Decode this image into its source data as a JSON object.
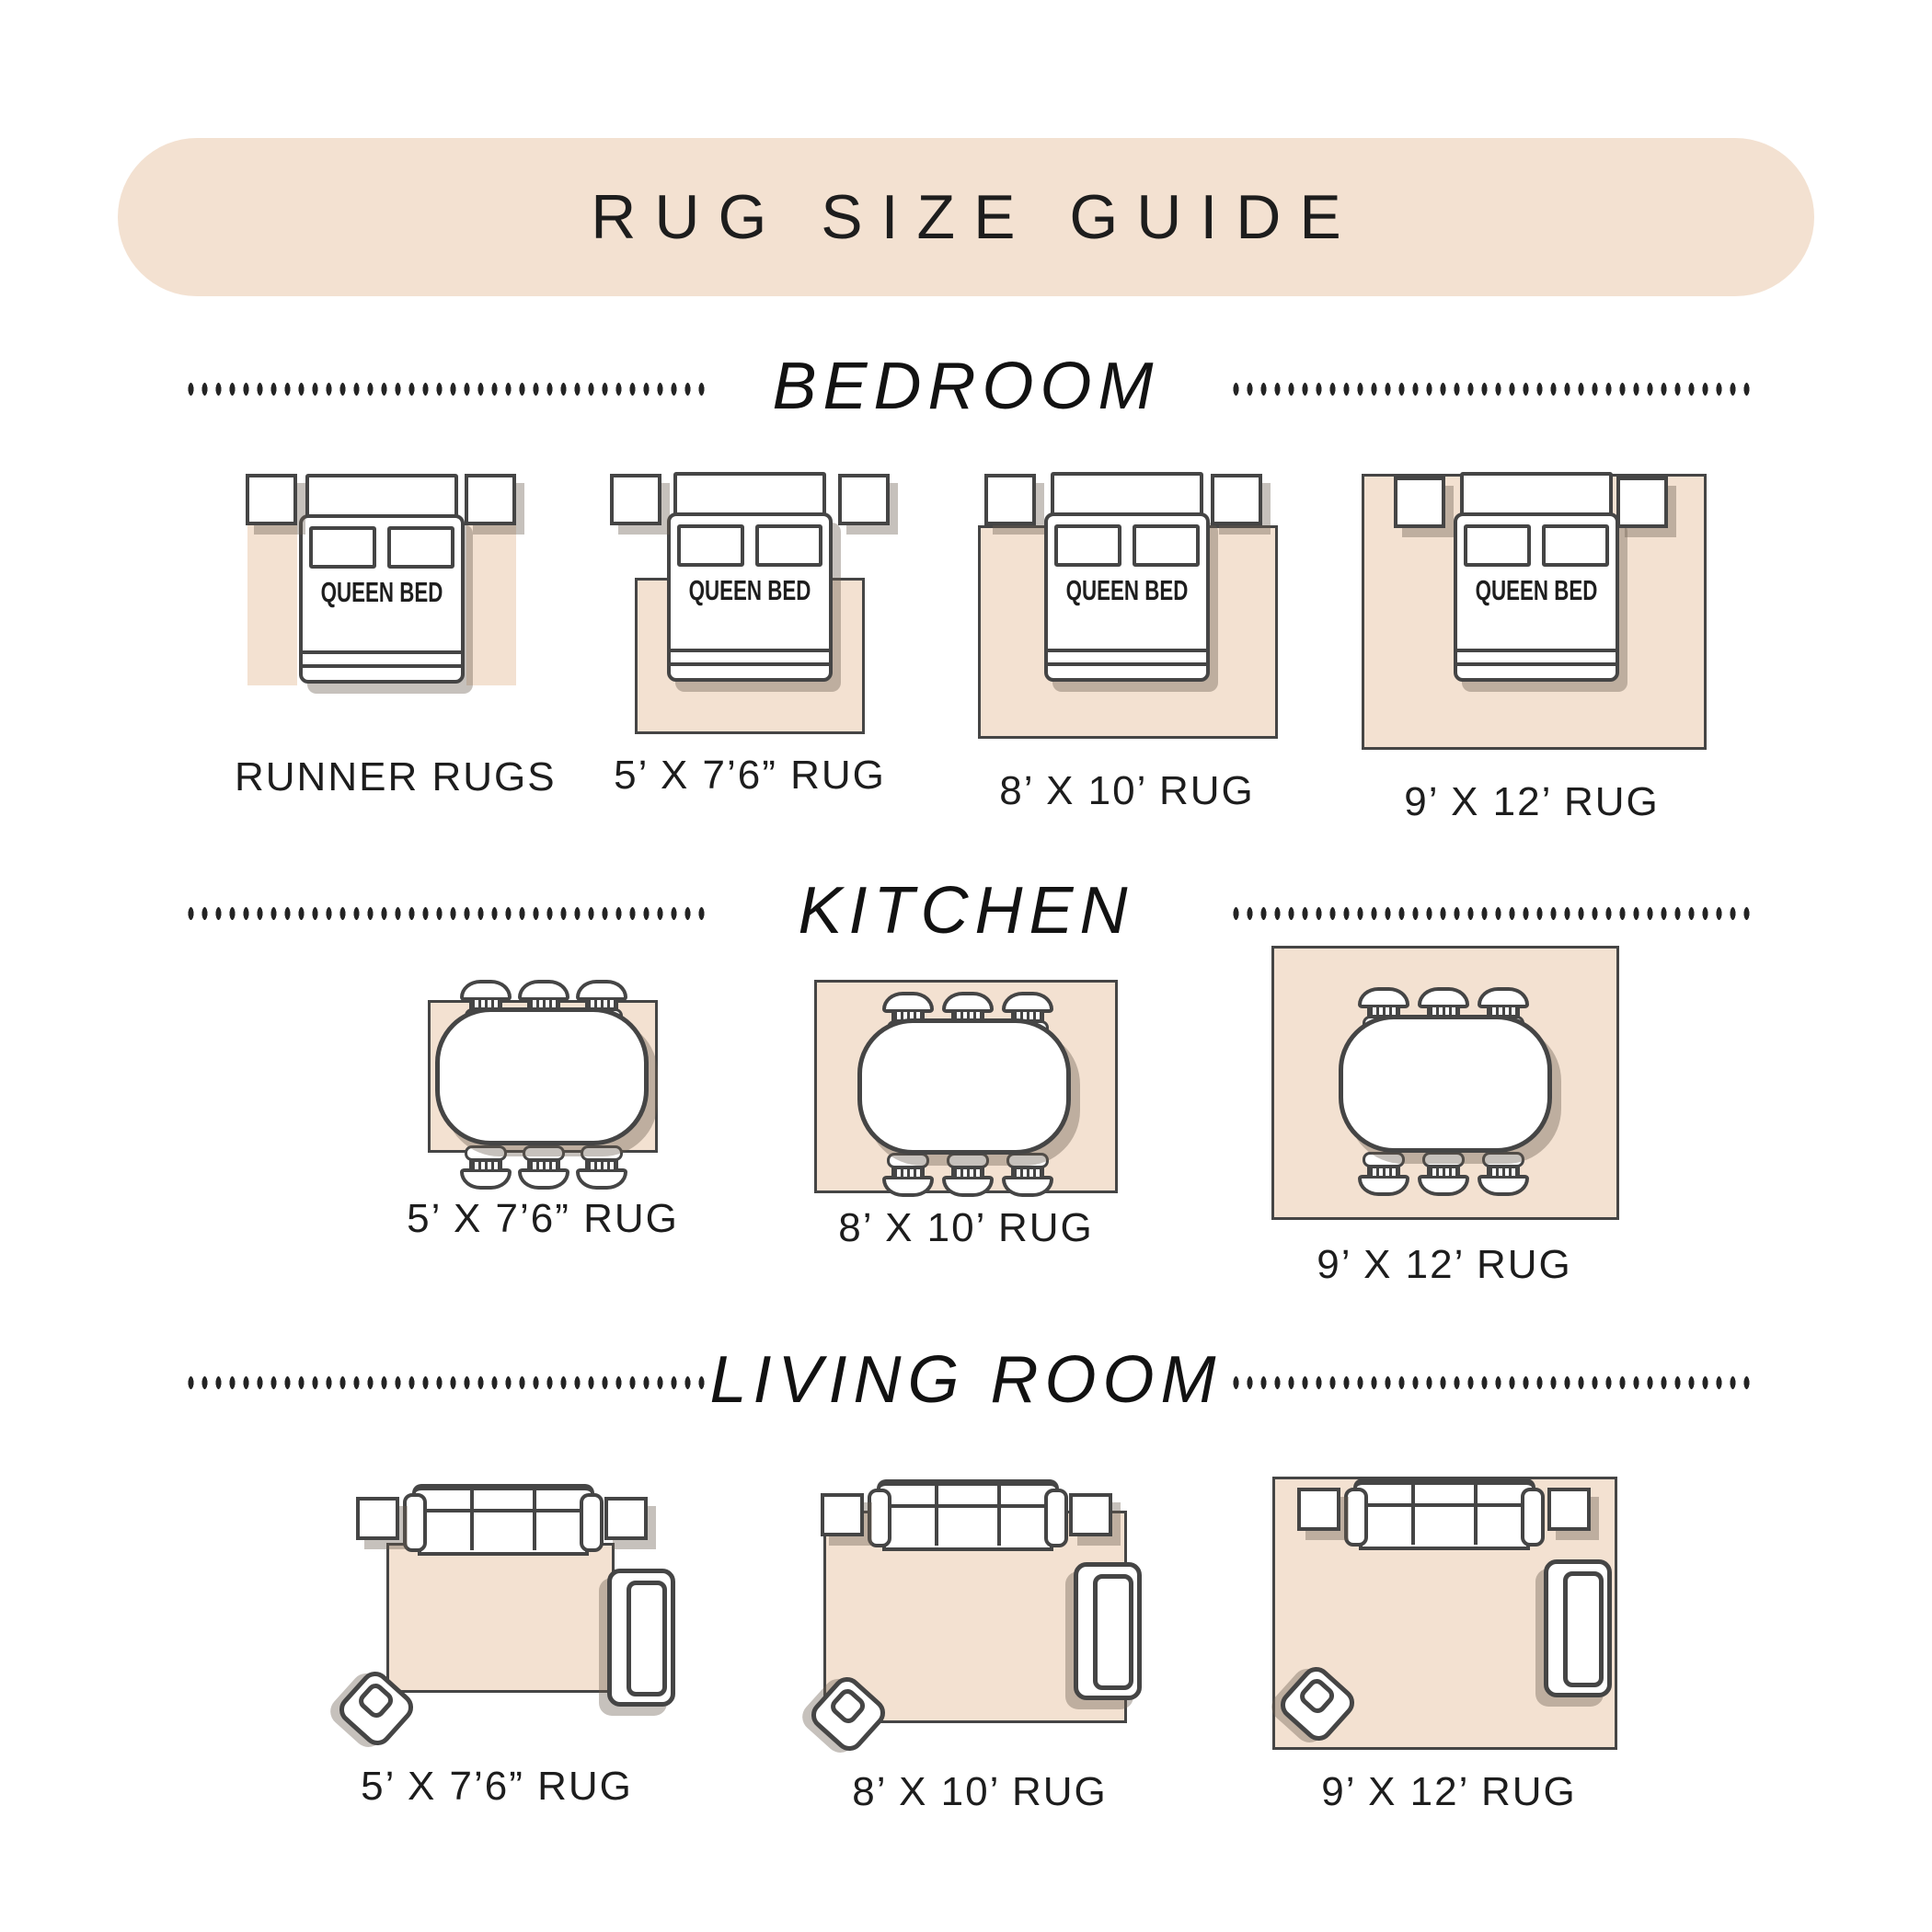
{
  "title": "RUG SIZE GUIDE",
  "colors": {
    "beige": "#f3e1d1",
    "line": "#454545",
    "shadow": "rgba(104,92,80,0.38)",
    "text": "#1d1d1d"
  },
  "sections": [
    {
      "name": "BEDROOM",
      "bed_label": "QUEEN BED",
      "items": [
        {
          "label": "RUNNER RUGS"
        },
        {
          "label": "5’ X 7’6” RUG"
        },
        {
          "label": "8’ X 10’ RUG"
        },
        {
          "label": "9’ X 12’ RUG"
        }
      ]
    },
    {
      "name": "KITCHEN",
      "items": [
        {
          "label": "5’ X 7’6” RUG"
        },
        {
          "label": "8’ X 10’ RUG"
        },
        {
          "label": "9’ X 12’ RUG"
        }
      ]
    },
    {
      "name": "LIVING ROOM",
      "items": [
        {
          "label": "5’ X 7’6” RUG"
        },
        {
          "label": "8’ X 10’ RUG"
        },
        {
          "label": "9’ X 12’ RUG"
        }
      ]
    }
  ]
}
